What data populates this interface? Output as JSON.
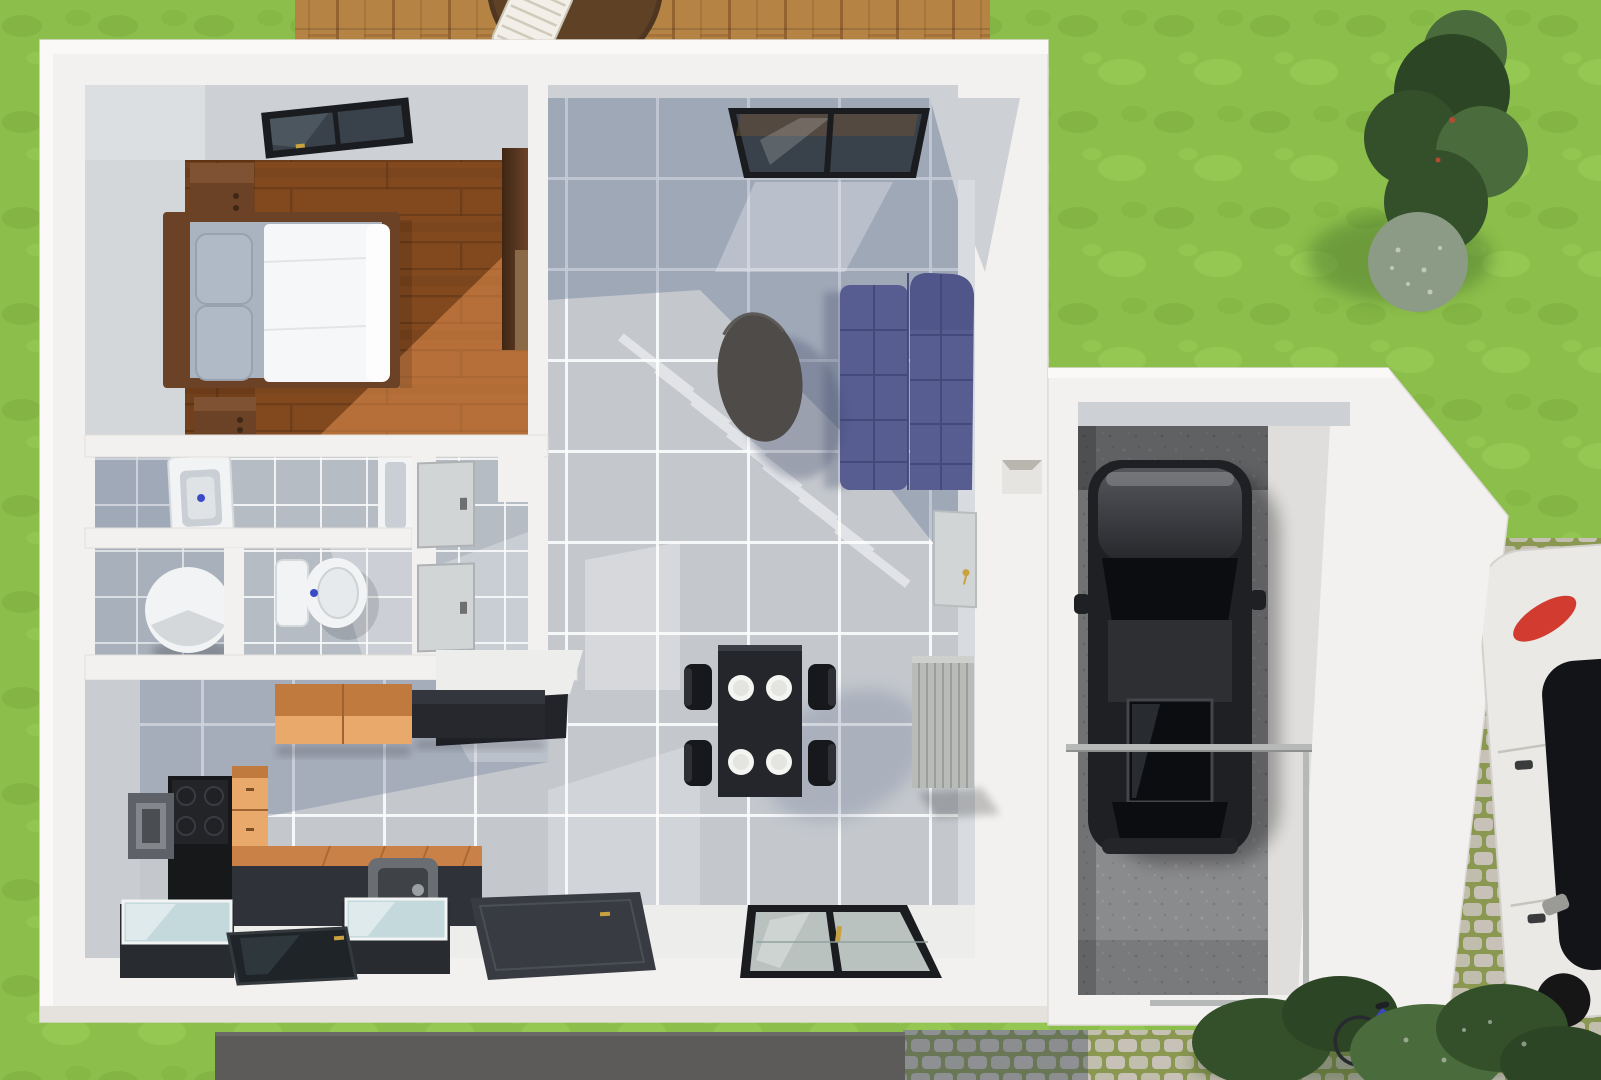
{
  "scene": {
    "title": "3D top-down floor plan rendering of a single-family house ground floor with attached garage",
    "view": "aerial orthographic / dollhouse view",
    "style": "architectural 3D render, no visible text"
  },
  "colors": {
    "grass": "#8CBE4B",
    "grassDark": "#79A93C",
    "grassLight": "#9ED25B",
    "deckWood": "#B58445",
    "deckLine": "#8A5B2C",
    "deckTable": "#5F4226",
    "deckChair": "#F2EFE8",
    "wall": "#F2F1EF",
    "wallBright": "#FAF9F7",
    "wallFace": "#CDD1D6",
    "wallFaceLight": "#D8DBDF",
    "wallShade": "#E5E2DE",
    "woodFloor": "#82491F",
    "woodLine": "#5C3314",
    "woodSun": "#FFA45C",
    "tile": "#C4C8CD",
    "tileBath": "#B6BCC4",
    "grout": "#FFFFFF",
    "shadowBlue": "#5E6E8F",
    "litFloor": "#EDEEEC",
    "stairLight": "#E0CB9B",
    "stairDark": "#C3B183",
    "stairLine": "#8F8059",
    "sofa": "#575C91",
    "sofaSeam": "#424879",
    "coffeeTable": "#4E4B49",
    "diningTable": "#24262B",
    "chair": "#17181C",
    "plate": "#F4F4F2",
    "radiator": "#B8BBB8",
    "radiatorLine": "#9A9D9A",
    "frame": "#1A1C1F",
    "glassDark": "#39424A",
    "glassLight": "#B9C2BF",
    "gold": "#C9A23F",
    "cabOrange": "#E8A96B",
    "cabOrangeTop": "#C07A3E",
    "cabBlack": "#26282E",
    "counter": "#2F3339",
    "counterTop": "#C98147",
    "sink": "#6A6E73",
    "applGlass": "#C3D9DB",
    "applBody": "#282B2F",
    "hob": "#17181A",
    "grayBox": "#5E6268",
    "bedWood": "#6B4226",
    "wardrobe": "#3E2614",
    "wardrobeLight": "#8A6A46",
    "pillow": "#AFBAC6",
    "mattress": "#A9B4C0",
    "duvet": "#F6F7F8",
    "fixture": "#F2F3F4",
    "fixtureInset": "#C9CFD4",
    "drainBlue": "#3B4BC8",
    "door": "#D2D5D6",
    "doorEdge": "#AEB2B4",
    "handle": "#6D6F70",
    "concrete": "#8A8B8D",
    "carBody": "#1F2023",
    "carHood": "#55565B",
    "carGlass": "#0C0D10",
    "carRoof": "#2E2F33",
    "whiteCar": "#EAE9E5",
    "whiteCarGlass": "#131417",
    "tailRed": "#D23B2F",
    "cobble": "#C7C1B7",
    "cobbleGap": "#8A9851",
    "pathDark": "#5D5B59",
    "treeDark": "#33502A",
    "treeMid": "#4A6B3C",
    "treeDeep": "#2C4524",
    "sage": "#8C9B86",
    "treeShadow": "#4F7A2E",
    "bike": "#3A45C0",
    "railing": "#B7B9B8"
  },
  "outdoor": {
    "lawn": {
      "label": "lawn"
    },
    "deck": {
      "label": "wooden terrace deck",
      "furniture": [
        "round garden table",
        "white lounge chair"
      ]
    },
    "trees": {
      "label": "conifer and shrub group"
    },
    "paving": {
      "label": "cobblestone driveway paving"
    },
    "path": {
      "label": "dark gravel strip"
    },
    "bushes": {
      "label": "hedge shrubs"
    },
    "bicycle": {
      "label": "blue bicycle"
    },
    "parked_car": {
      "label": "white car parked beside garage"
    }
  },
  "rooms": {
    "bedroom": {
      "label": "bedroom",
      "floor": "wood planks",
      "furniture": [
        "double bed with white duvet and two grey pillows",
        "two wooden nightstands",
        "tall wardrobe",
        "dark roof window"
      ]
    },
    "stairs": {
      "label": "winder staircase to upper floor"
    },
    "living_room": {
      "label": "living room",
      "furniture": [
        "purple corner sofa",
        "dark oval coffee table",
        "picture window"
      ]
    },
    "dining_area": {
      "label": "dining area",
      "furniture": [
        "black dining table set for four",
        "four black chairs",
        "four white plates",
        "wall radiator",
        "low window",
        "dark doormat"
      ]
    },
    "kitchen": {
      "label": "kitchen",
      "furniture": [
        "orange wall cabinet",
        "black wall cabinet",
        "induction hob column",
        "orange drawer unit",
        "counter with square sink",
        "two glass-top appliances",
        "dark glass floor panel"
      ]
    },
    "bathroom": {
      "label": "bathroom",
      "fixtures": [
        "pedestal washbasin",
        "bathtub end"
      ]
    },
    "utility": {
      "label": "utility room",
      "fixtures": [
        "round water heater"
      ]
    },
    "wc": {
      "label": "toilet room",
      "fixtures": [
        "toilet with cistern"
      ]
    },
    "hall": {
      "label": "hallway",
      "fixtures": [
        "two grey interior doors",
        "under-stair closet"
      ]
    },
    "garage": {
      "label": "garage",
      "contents": [
        "black car",
        "glass guard rail",
        "service door with key",
        "wall niche"
      ]
    }
  }
}
